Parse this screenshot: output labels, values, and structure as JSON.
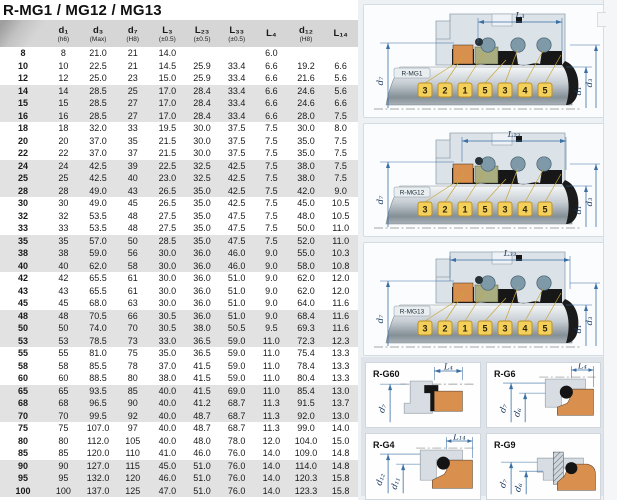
{
  "title": "R-MG1 / MG12 / MG13",
  "table": {
    "headers": [
      {
        "main": "",
        "sub": ""
      },
      {
        "main": "d₁",
        "sub": "(h6)"
      },
      {
        "main": "d₃",
        "sub": "(Max)"
      },
      {
        "main": "d₇",
        "sub": "(H8)"
      },
      {
        "main": "L₃",
        "sub": "(±0.5)"
      },
      {
        "main": "L₂₃",
        "sub": "(±0.5)"
      },
      {
        "main": "L₃₃",
        "sub": "(±0.5)"
      },
      {
        "main": "L₄",
        "sub": ""
      },
      {
        "main": "d₁₂",
        "sub": "(H8)"
      },
      {
        "main": "L₁₄",
        "sub": ""
      }
    ],
    "rows": [
      {
        "size": "8",
        "values": [
          "8",
          "21.0",
          "21",
          "14.0",
          "",
          "",
          "6.0",
          "",
          ""
        ]
      },
      {
        "size": "10",
        "values": [
          "10",
          "22.5",
          "21",
          "14.5",
          "25.9",
          "33.4",
          "6.6",
          "19.2",
          "6.6"
        ]
      },
      {
        "size": "12",
        "values": [
          "12",
          "25.0",
          "23",
          "15.0",
          "25.9",
          "33.4",
          "6.6",
          "21.6",
          "5.6"
        ]
      },
      {
        "size": "14",
        "values": [
          "14",
          "28.5",
          "25",
          "17.0",
          "28.4",
          "33.4",
          "6.6",
          "24.6",
          "5.6"
        ]
      },
      {
        "size": "15",
        "values": [
          "15",
          "28.5",
          "27",
          "17.0",
          "28.4",
          "33.4",
          "6.6",
          "24.6",
          "6.6"
        ]
      },
      {
        "size": "16",
        "values": [
          "16",
          "28.5",
          "27",
          "17.0",
          "28.4",
          "33.4",
          "6.6",
          "28.0",
          "7.5"
        ]
      },
      {
        "size": "18",
        "values": [
          "18",
          "32.0",
          "33",
          "19.5",
          "30.0",
          "37.5",
          "7.5",
          "30.0",
          "8.0"
        ]
      },
      {
        "size": "20",
        "values": [
          "20",
          "37.0",
          "35",
          "21.5",
          "30.0",
          "37.5",
          "7.5",
          "35.0",
          "7.5"
        ]
      },
      {
        "size": "22",
        "values": [
          "22",
          "37.0",
          "37",
          "21.5",
          "30.0",
          "37.5",
          "7.5",
          "35.0",
          "7.5"
        ]
      },
      {
        "size": "24",
        "values": [
          "24",
          "42.5",
          "39",
          "22.5",
          "32.5",
          "42.5",
          "7.5",
          "38.0",
          "7.5"
        ]
      },
      {
        "size": "25",
        "values": [
          "25",
          "42.5",
          "40",
          "23.0",
          "32.5",
          "42.5",
          "7.5",
          "38.0",
          "7.5"
        ]
      },
      {
        "size": "28",
        "values": [
          "28",
          "49.0",
          "43",
          "26.5",
          "35.0",
          "42.5",
          "7.5",
          "42.0",
          "9.0"
        ]
      },
      {
        "size": "30",
        "values": [
          "30",
          "49.0",
          "45",
          "26.5",
          "35.0",
          "42.5",
          "7.5",
          "45.0",
          "10.5"
        ]
      },
      {
        "size": "32",
        "values": [
          "32",
          "53.5",
          "48",
          "27.5",
          "35.0",
          "47.5",
          "7.5",
          "48.0",
          "10.5"
        ]
      },
      {
        "size": "33",
        "values": [
          "33",
          "53.5",
          "48",
          "27.5",
          "35.0",
          "47.5",
          "7.5",
          "50.0",
          "11.0"
        ]
      },
      {
        "size": "35",
        "values": [
          "35",
          "57.0",
          "50",
          "28.5",
          "35.0",
          "47.5",
          "7.5",
          "52.0",
          "11.0"
        ]
      },
      {
        "size": "38",
        "values": [
          "38",
          "59.0",
          "56",
          "30.0",
          "36.0",
          "46.0",
          "9.0",
          "55.0",
          "10.3"
        ]
      },
      {
        "size": "40",
        "values": [
          "40",
          "62.0",
          "58",
          "30.0",
          "36.0",
          "46.0",
          "9.0",
          "58.0",
          "10.8"
        ]
      },
      {
        "size": "42",
        "values": [
          "42",
          "65.5",
          "61",
          "30.0",
          "36.0",
          "51.0",
          "9.0",
          "62.0",
          "12.0"
        ]
      },
      {
        "size": "43",
        "values": [
          "43",
          "65.5",
          "61",
          "30.0",
          "36.0",
          "51.0",
          "9.0",
          "62.0",
          "12.0"
        ]
      },
      {
        "size": "45",
        "values": [
          "45",
          "68.0",
          "63",
          "30.0",
          "36.0",
          "51.0",
          "9.0",
          "64.0",
          "11.6"
        ]
      },
      {
        "size": "48",
        "values": [
          "48",
          "70.5",
          "66",
          "30.5",
          "36.0",
          "51.0",
          "9.0",
          "68.4",
          "11.6"
        ]
      },
      {
        "size": "50",
        "values": [
          "50",
          "74.0",
          "70",
          "30.5",
          "38.0",
          "50.5",
          "9.5",
          "69.3",
          "11.6"
        ]
      },
      {
        "size": "53",
        "values": [
          "53",
          "78.5",
          "73",
          "33.0",
          "36.5",
          "59.0",
          "11.0",
          "72.3",
          "12.3"
        ]
      },
      {
        "size": "55",
        "values": [
          "55",
          "81.0",
          "75",
          "35.0",
          "36.5",
          "59.0",
          "11.0",
          "75.4",
          "13.3"
        ]
      },
      {
        "size": "58",
        "values": [
          "58",
          "85.5",
          "78",
          "37.0",
          "41.5",
          "59.0",
          "11.0",
          "78.4",
          "13.3"
        ]
      },
      {
        "size": "60",
        "values": [
          "60",
          "88.5",
          "80",
          "38.0",
          "41.5",
          "59.0",
          "11.0",
          "80.4",
          "13.3"
        ]
      },
      {
        "size": "65",
        "values": [
          "65",
          "93.5",
          "85",
          "40.0",
          "41.5",
          "69.0",
          "11.0",
          "85.4",
          "13.0"
        ]
      },
      {
        "size": "68",
        "values": [
          "68",
          "96.5",
          "90",
          "40.0",
          "41.2",
          "68.7",
          "11.3",
          "91.5",
          "13.7"
        ]
      },
      {
        "size": "70",
        "values": [
          "70",
          "99.5",
          "92",
          "40.0",
          "48.7",
          "68.7",
          "11.3",
          "92.0",
          "13.0"
        ]
      },
      {
        "size": "75",
        "values": [
          "75",
          "107.0",
          "97",
          "40.0",
          "48.7",
          "68.7",
          "11.3",
          "99.0",
          "14.0"
        ]
      },
      {
        "size": "80",
        "values": [
          "80",
          "112.0",
          "105",
          "40.0",
          "48.0",
          "78.0",
          "12.0",
          "104.0",
          "15.0"
        ]
      },
      {
        "size": "85",
        "values": [
          "85",
          "120.0",
          "110",
          "41.0",
          "46.0",
          "76.0",
          "14.0",
          "109.0",
          "14.8"
        ]
      },
      {
        "size": "90",
        "values": [
          "90",
          "127.0",
          "115",
          "45.0",
          "51.0",
          "76.0",
          "14.0",
          "114.0",
          "14.8"
        ]
      },
      {
        "size": "95",
        "values": [
          "95",
          "132.0",
          "120",
          "46.0",
          "51.0",
          "76.0",
          "14.0",
          "120.3",
          "15.8"
        ]
      },
      {
        "size": "100",
        "values": [
          "100",
          "137.0",
          "125",
          "47.0",
          "51.0",
          "76.0",
          "14.0",
          "123.3",
          "15.8"
        ]
      }
    ]
  },
  "diagrams": [
    {
      "label": "R-MG1",
      "dim_top": "L₃",
      "dim_left": "d₇",
      "dim_inner": "d₁",
      "dim_outer": "d₃",
      "callouts": [
        "3",
        "2",
        "1",
        "5",
        "3",
        "4",
        "5"
      ],
      "dim_span": [
        112,
        196
      ]
    },
    {
      "label": "R-MG12",
      "dim_top": "L₂₃",
      "dim_left": "d₇",
      "dim_inner": "d₁",
      "dim_outer": "d₃",
      "callouts": [
        "3",
        "2",
        "1",
        "5",
        "3",
        "4",
        "5"
      ],
      "dim_span": [
        96,
        200
      ]
    },
    {
      "label": "R-MG13",
      "dim_top": "L₃₃",
      "dim_left": "d₇",
      "dim_inner": "d₁",
      "dim_outer": "d₃",
      "callouts": [
        "3",
        "2",
        "1",
        "5",
        "3",
        "4",
        "5"
      ],
      "dim_span": [
        84,
        204
      ]
    }
  ],
  "seat_panels": [
    {
      "label": "R-G60",
      "dim_top": "L₄",
      "dims_left": [
        "d₇"
      ]
    },
    {
      "label": "R-G6",
      "dim_top": "L₄",
      "dims_left": [
        "d₇",
        "d₆"
      ]
    },
    {
      "label": "R-G4",
      "dim_top": "L₁₄",
      "dims_left": [
        "d₁₂",
        "d₁₁"
      ]
    },
    {
      "label": "R-G9",
      "dim_top": "",
      "dims_left": [
        "d₇",
        "d₆"
      ]
    }
  ],
  "colors": {
    "dimension_blue": "#3a6fa5",
    "callout_yellow": "#f3cf5c",
    "callout_border": "#bd9028",
    "seal_face_orange": "#d9904f",
    "seal_face_olive": "#a9ad80",
    "spring_gray_blue": "#7e99a8",
    "elastomer_black": "#171717",
    "header_gray": "#d6d6d6",
    "row_band_gray": "#e2e2e2"
  }
}
